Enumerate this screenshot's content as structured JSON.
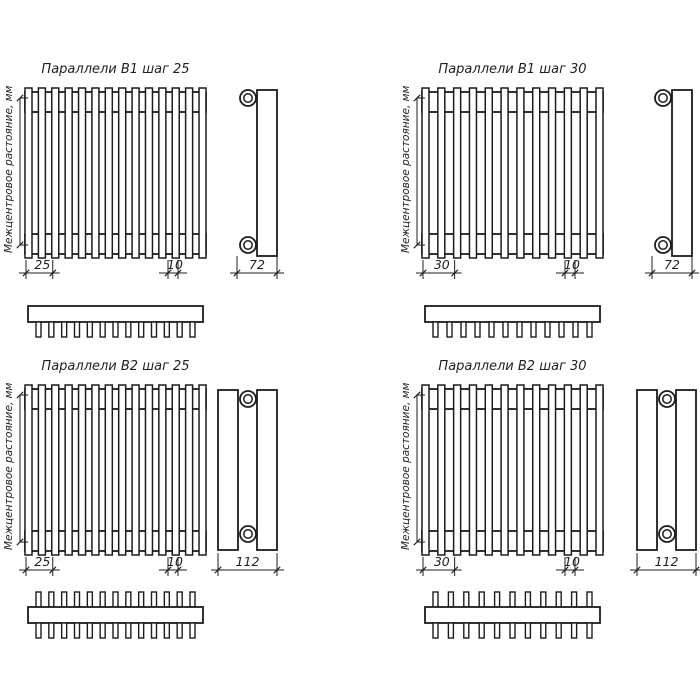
{
  "page": {
    "background": "#ffffff",
    "line_color": "#1c1c1c",
    "text_color": "#1f1f1f"
  },
  "center_distance_label": "Межцентровое растояние, мм",
  "quadrants": [
    {
      "id": "b1-step-25",
      "title": "Параллели B1 шаг 25",
      "series": "B1",
      "step_mm": "25",
      "tube_width_mm": "10",
      "depth_mm": "72",
      "rows": 1,
      "front_tubes": 14,
      "plan_tubes": 13
    },
    {
      "id": "b1-step-30",
      "title": "Параллели B1 шаг 30",
      "series": "B1",
      "step_mm": "30",
      "tube_width_mm": "10",
      "depth_mm": "72",
      "rows": 1,
      "front_tubes": 12,
      "plan_tubes": 12
    },
    {
      "id": "b2-step-25",
      "title": "Параллели B2 шаг 25",
      "series": "B2",
      "step_mm": "25",
      "tube_width_mm": "10",
      "depth_mm": "112",
      "rows": 2,
      "front_tubes": 14,
      "plan_tubes": 13
    },
    {
      "id": "b2-step-30",
      "title": "Параллели B2 шаг 30",
      "series": "B2",
      "step_mm": "30",
      "tube_width_mm": "10",
      "depth_mm": "112",
      "rows": 2,
      "front_tubes": 12,
      "plan_tubes": 11
    }
  ]
}
